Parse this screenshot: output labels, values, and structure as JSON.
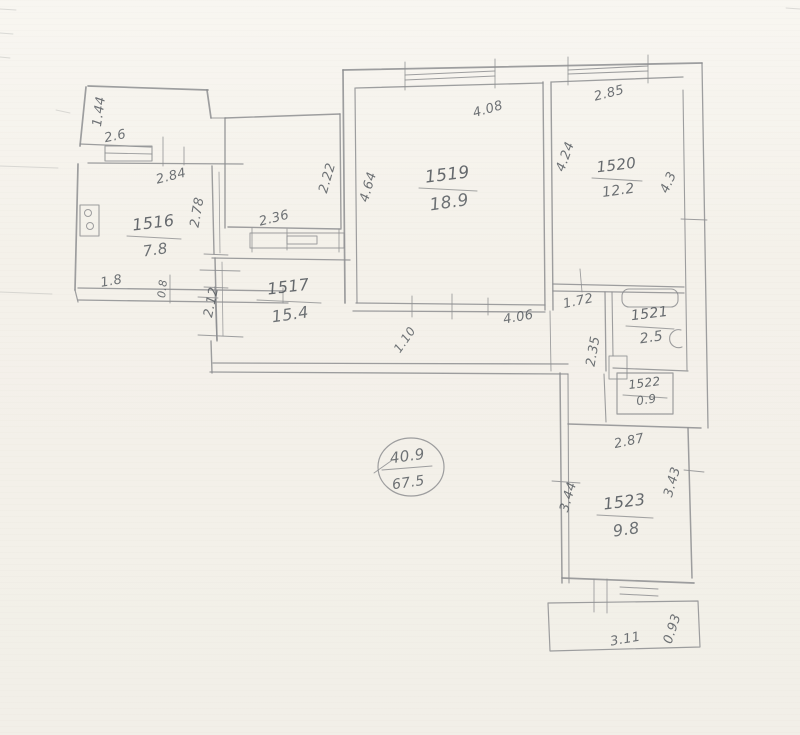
{
  "document": {
    "kind": "scanned hand-drawn apartment floor plan",
    "stamp": {
      "top": "40.9",
      "bottom": "67.5"
    }
  },
  "plan": {
    "rooms": [
      {
        "id": "1516",
        "area": "7.8",
        "x": 154,
        "y": 228,
        "w": 54,
        "dy": 27,
        "s": 16,
        "as": 15
      },
      {
        "id": "1517",
        "area": "15.4",
        "x": 289,
        "y": 292,
        "w": 64,
        "dy": 28,
        "s": 16,
        "as": 16
      },
      {
        "id": "1519",
        "area": "18.9",
        "x": 448,
        "y": 180,
        "w": 58,
        "dy": 28,
        "s": 17,
        "as": 17
      },
      {
        "id": "1520",
        "area": "12.2",
        "x": 617,
        "y": 170,
        "w": 50,
        "dy": 25,
        "s": 15,
        "as": 14
      },
      {
        "id": "1521",
        "area": "2.5",
        "x": 650,
        "y": 318,
        "w": 48,
        "dy": 24,
        "s": 14,
        "as": 14
      },
      {
        "id": "1522",
        "area": "0.9",
        "x": 645,
        "y": 387,
        "w": 44,
        "dy": 17,
        "s": 12,
        "as": 12
      },
      {
        "id": "1523",
        "area": "9.8",
        "x": 625,
        "y": 507,
        "w": 56,
        "dy": 28,
        "s": 16,
        "as": 16
      }
    ],
    "dimensions": [
      {
        "t": "1.44",
        "x": 103,
        "y": 112,
        "r": -82
      },
      {
        "t": "2.6",
        "x": 116,
        "y": 140,
        "r": -12
      },
      {
        "t": "2.84",
        "x": 172,
        "y": 180,
        "r": -14
      },
      {
        "t": "2.78",
        "x": 201,
        "y": 213,
        "r": -80
      },
      {
        "t": "1.8",
        "x": 112,
        "y": 285,
        "r": -10
      },
      {
        "t": "0.8",
        "x": 166,
        "y": 289,
        "r": -84,
        "s": 11
      },
      {
        "t": "2.22",
        "x": 331,
        "y": 179,
        "r": -74
      },
      {
        "t": "2.36",
        "x": 275,
        "y": 222,
        "r": -14
      },
      {
        "t": "2.12",
        "x": 215,
        "y": 303,
        "r": -78
      },
      {
        "t": "4.64",
        "x": 372,
        "y": 188,
        "r": -74
      },
      {
        "t": "4.08",
        "x": 489,
        "y": 113,
        "r": -16
      },
      {
        "t": "4.24",
        "x": 569,
        "y": 158,
        "r": -70
      },
      {
        "t": "4.06",
        "x": 519,
        "y": 321,
        "r": -10
      },
      {
        "t": "2.85",
        "x": 610,
        "y": 97,
        "r": -14
      },
      {
        "t": "4.3",
        "x": 672,
        "y": 184,
        "r": -66
      },
      {
        "t": "1.72",
        "x": 579,
        "y": 305,
        "r": -12
      },
      {
        "t": "2.35",
        "x": 597,
        "y": 352,
        "r": -80
      },
      {
        "t": "1.10",
        "x": 408,
        "y": 342,
        "r": -55,
        "s": 12
      },
      {
        "t": "2.87",
        "x": 630,
        "y": 445,
        "r": -12
      },
      {
        "t": "3.44",
        "x": 572,
        "y": 498,
        "r": -74
      },
      {
        "t": "3.43",
        "x": 676,
        "y": 483,
        "r": -74
      },
      {
        "t": "3.11",
        "x": 626,
        "y": 643,
        "r": -10
      },
      {
        "t": "0.93",
        "x": 676,
        "y": 630,
        "r": -72
      }
    ],
    "stamp": {
      "top": "40.9",
      "bottom": "67.5",
      "x": 408,
      "y": 461,
      "by": 487
    },
    "walls": [
      [
        88,
        86,
        208,
        90,
        1.7
      ],
      [
        86,
        87,
        80,
        146,
        1.7
      ],
      [
        80,
        144,
        151,
        147,
        1.2
      ],
      [
        207,
        90,
        211,
        118,
        1.7
      ],
      [
        211,
        118,
        226,
        118,
        1.1
      ],
      [
        88,
        163,
        243,
        164,
        1.3
      ],
      [
        163,
        137,
        163,
        166,
        0.9
      ],
      [
        184,
        147,
        184,
        165,
        0.9
      ],
      [
        78,
        164,
        75,
        290,
        1.7
      ],
      [
        212,
        166,
        214,
        254,
        1.4
      ],
      [
        219,
        172,
        220,
        253,
        0.8
      ],
      [
        215,
        287,
        217,
        341,
        1.4
      ],
      [
        204,
        254,
        228,
        255,
        0.9
      ],
      [
        204,
        287,
        228,
        288,
        0.9
      ],
      [
        105,
        153,
        152,
        154,
        0.9
      ],
      [
        78,
        288,
        286,
        291,
        1.3
      ],
      [
        78,
        300,
        288,
        303,
        1.3
      ],
      [
        75,
        290,
        78,
        302,
        1.2
      ],
      [
        170,
        275,
        170,
        303,
        0.9
      ],
      [
        283,
        288,
        283,
        303,
        0.9
      ],
      [
        225,
        118,
        340,
        114,
        1.4
      ],
      [
        225,
        118,
        225,
        228,
        1.4
      ],
      [
        340,
        114,
        341,
        228,
        1.4
      ],
      [
        228,
        227,
        341,
        229,
        1.4
      ],
      [
        252,
        228,
        252,
        252,
        0.9
      ],
      [
        287,
        229,
        287,
        250,
        0.9
      ],
      [
        339,
        229,
        339,
        252,
        0.9
      ],
      [
        212,
        258,
        350,
        260,
        1.3
      ],
      [
        215,
        258,
        217,
        340,
        1.5
      ],
      [
        222,
        262,
        223,
        336,
        0.8
      ],
      [
        200,
        270,
        240,
        271,
        0.9
      ],
      [
        198,
        297,
        218,
        298,
        0.9
      ],
      [
        198,
        335,
        243,
        337,
        0.9
      ],
      [
        211,
        341,
        212,
        373,
        1.4
      ],
      [
        213,
        363,
        568,
        364,
        1.3
      ],
      [
        210,
        372,
        568,
        374,
        1.3
      ],
      [
        550,
        311,
        551,
        371,
        0.9
      ],
      [
        343,
        70,
        702,
        63,
        1.8
      ],
      [
        356,
        88,
        543,
        83,
        1.3
      ],
      [
        552,
        82,
        683,
        77,
        1.3
      ],
      [
        343,
        70,
        345,
        303,
        1.7
      ],
      [
        355,
        88,
        357,
        303,
        1.2
      ],
      [
        356,
        303,
        545,
        305,
        1.3
      ],
      [
        353,
        311,
        545,
        312,
        1.3
      ],
      [
        412,
        296,
        412,
        317,
        0.9
      ],
      [
        452,
        294,
        452,
        319,
        0.9
      ],
      [
        488,
        298,
        488,
        315,
        0.9
      ],
      [
        543,
        82,
        545,
        310,
        1.4
      ],
      [
        551,
        82,
        553,
        310,
        1.4
      ],
      [
        405,
        75,
        495,
        71,
        1.1
      ],
      [
        405,
        80,
        495,
        76,
        1.1
      ],
      [
        405,
        62,
        405,
        90,
        0.9
      ],
      [
        495,
        59,
        495,
        88,
        0.9
      ],
      [
        568,
        70,
        648,
        66,
        1.1
      ],
      [
        568,
        74,
        648,
        71,
        1.1
      ],
      [
        568,
        57,
        568,
        85,
        0.9
      ],
      [
        648,
        55,
        648,
        83,
        0.9
      ],
      [
        702,
        63,
        708,
        428,
        1.3
      ],
      [
        683,
        90,
        687,
        370,
        1.1
      ],
      [
        681,
        219,
        707,
        220,
        0.9
      ],
      [
        553,
        284,
        684,
        287,
        1.3
      ],
      [
        553,
        291,
        684,
        293,
        1.3
      ],
      [
        580,
        269,
        582,
        292,
        0.9
      ],
      [
        605,
        292,
        606,
        371,
        1.3
      ],
      [
        612,
        292,
        613,
        356,
        1.1
      ],
      [
        604,
        374,
        606,
        422,
        1.1
      ],
      [
        613,
        368,
        688,
        371,
        1.2
      ],
      [
        560,
        373,
        562,
        583,
        1.5
      ],
      [
        568,
        374,
        569,
        583,
        1.1
      ],
      [
        568,
        424,
        701,
        428,
        1.5
      ],
      [
        688,
        428,
        692,
        578,
        1.5
      ],
      [
        562,
        578,
        694,
        583,
        1.7
      ],
      [
        552,
        481,
        580,
        483,
        0.9
      ],
      [
        684,
        470,
        704,
        472,
        0.9
      ],
      [
        594,
        579,
        594,
        612,
        0.9
      ],
      [
        607,
        579,
        607,
        613,
        0.9
      ],
      [
        620,
        587,
        658,
        589,
        1.0
      ],
      [
        620,
        594,
        658,
        596,
        1.0
      ],
      [
        382,
        470,
        432,
        466,
        1.0
      ],
      [
        374,
        473,
        391,
        461,
        0.9
      ]
    ],
    "faint": [
      [
        0,
        9,
        16,
        10
      ],
      [
        0,
        33,
        13,
        34
      ],
      [
        0,
        57,
        10,
        58
      ],
      [
        56,
        110,
        70,
        113
      ],
      [
        786,
        8,
        800,
        9
      ],
      [
        0,
        166,
        58,
        168
      ],
      [
        0,
        292,
        52,
        294
      ]
    ],
    "rects": [
      {
        "x": 105,
        "y": 146,
        "w": 47,
        "h": 15,
        "sw": 1.1,
        "name": "vestibule-window"
      },
      {
        "x": 250,
        "y": 233,
        "w": 94,
        "h": 15,
        "sw": 1.0,
        "name": "built-in-closet"
      },
      {
        "x": 287,
        "y": 236,
        "w": 30,
        "h": 8,
        "sw": 1.0,
        "name": "closet-inner"
      },
      {
        "x": 80,
        "y": 205,
        "w": 19,
        "h": 31,
        "sw": 1.1,
        "name": "stove"
      },
      {
        "x": 622,
        "y": 289,
        "w": 56,
        "h": 18,
        "rx": 7,
        "sw": 1.1,
        "name": "bathtub"
      },
      {
        "x": 609,
        "y": 356,
        "w": 18,
        "h": 23,
        "sw": 1.0,
        "name": "door-leaf"
      },
      {
        "x": 617,
        "y": 373,
        "w": 56,
        "h": 41,
        "sw": 1.2,
        "name": "room-1522-outline"
      }
    ],
    "ellipses": [
      {
        "cx": 411,
        "cy": 467,
        "rx": 33,
        "ry": 29,
        "sw": 1.2,
        "name": "stamp-circle"
      },
      {
        "cx": 88,
        "cy": 213,
        "rx": 3.5,
        "ry": 3.5,
        "sw": 1.0,
        "name": "stove-burner"
      },
      {
        "cx": 90,
        "cy": 226,
        "rx": 3.5,
        "ry": 3.5,
        "sw": 1.0,
        "name": "stove-burner"
      }
    ],
    "paths": [
      {
        "d": "M 681,330 a 9,9 0 1 0 1,17",
        "sw": 1.1,
        "name": "sink"
      },
      {
        "d": "M548,603 L698,601 L700,647 L550,651 Z",
        "sw": 1.2,
        "name": "balcony-outline"
      }
    ]
  }
}
